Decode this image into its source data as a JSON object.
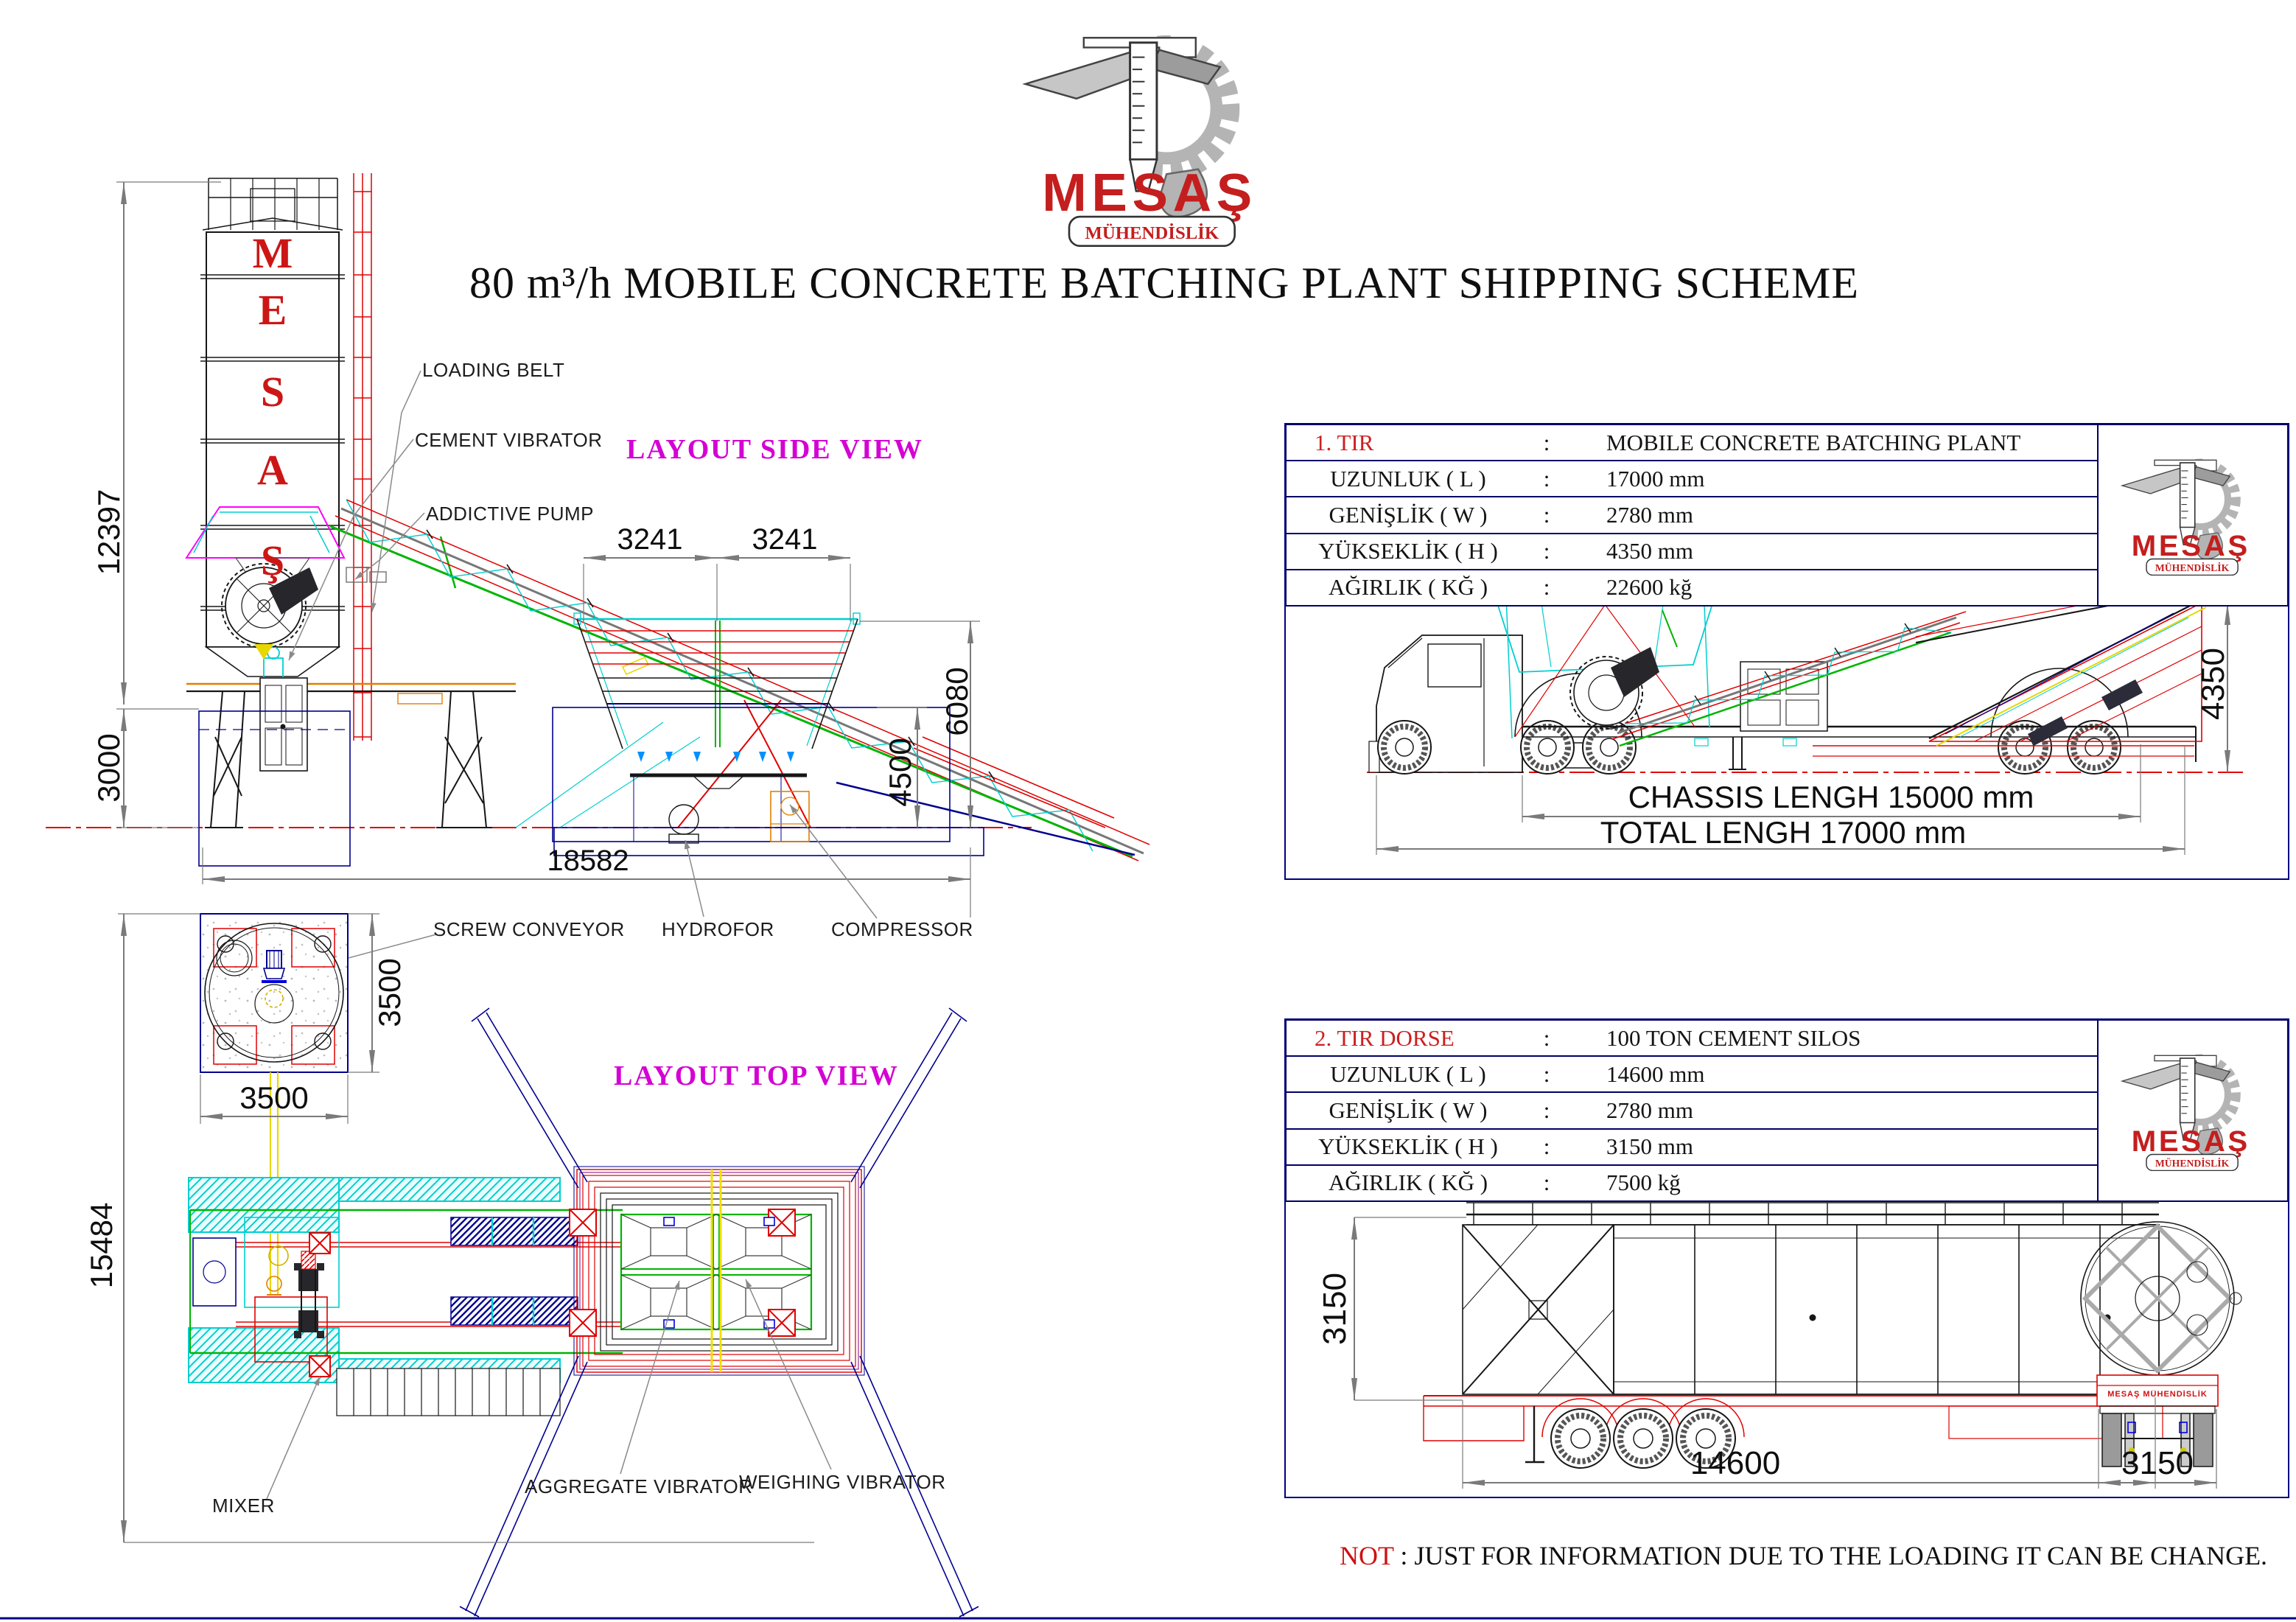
{
  "logo": {
    "brand": "MESAŞ",
    "tagline": "MÜHENDİSLİK"
  },
  "title": "80 m³/h MOBILE CONCRETE BATCHING PLANT SHIPPING SCHEME",
  "side_view": {
    "heading": "LAYOUT SIDE VIEW",
    "silo_letters": [
      "M",
      "E",
      "S",
      "A",
      "Ş"
    ],
    "labels": {
      "loading_belt": "LOADING BELT",
      "cement_vibrator": "CEMENT VIBRATOR",
      "addictive_pump": "ADDICTIVE PUMP",
      "screw_conveyor": "SCREW CONVEYOR",
      "hydrofor": "HYDROFOR",
      "compressor": "COMPRESSOR"
    },
    "dims": {
      "silo_height": "12397",
      "base_height": "3000",
      "bin_span_left": "3241",
      "bin_span_right": "3241",
      "bin_height": "4500",
      "bin_top_height": "6080",
      "total_length": "18582"
    }
  },
  "top_view": {
    "heading": "LAYOUT TOP VIEW",
    "labels": {
      "mixer": "MIXER",
      "aggregate_vibrator": "AGGREGATE VIBRATOR",
      "weighing_vibrator": "WEIGHING VIBRATOR"
    },
    "dims": {
      "silo_width": "3500",
      "silo_depth": "3500",
      "total_length": "15484"
    }
  },
  "truck_view": {
    "chassis_label": "CHASSIS LENGH 15000 mm",
    "total_label": "TOTAL LENGH 17000 mm",
    "dims": {
      "height": "4350"
    }
  },
  "trailer_view": {
    "mudflap_text": "MESAŞ MÜHENDİSLİK",
    "dims": {
      "height": "3150",
      "length": "14600",
      "width": "3150"
    }
  },
  "spec_table_1": {
    "rows": [
      {
        "label": "1. TIR",
        "sep": ":",
        "value": "MOBILE CONCRETE BATCHING PLANT"
      },
      {
        "label": "UZUNLUK ( L )",
        "sep": ":",
        "value": "17000 mm"
      },
      {
        "label": "GENİŞLİK ( W )",
        "sep": ":",
        "value": "2780 mm"
      },
      {
        "label": "YÜKSEKLİK ( H )",
        "sep": ":",
        "value": "4350 mm"
      },
      {
        "label": "AĞIRLIK ( KĞ )",
        "sep": ":",
        "value": "22600 kğ"
      }
    ]
  },
  "spec_table_2": {
    "rows": [
      {
        "label": "2. TIR DORSE",
        "sep": ":",
        "value": "100 TON CEMENT SILOS"
      },
      {
        "label": "UZUNLUK ( L )",
        "sep": ":",
        "value": "14600 mm"
      },
      {
        "label": "GENİŞLİK ( W )",
        "sep": ":",
        "value": "2780 mm"
      },
      {
        "label": "YÜKSEKLİK ( H )",
        "sep": ":",
        "value": "3150 mm"
      },
      {
        "label": "AĞIRLIK ( KĞ )",
        "sep": ":",
        "value": "7500 kğ"
      }
    ]
  },
  "note": {
    "prefix": "NOT",
    "body": " : JUST FOR INFORMATION DUE TO THE LOADING IT CAN BE CHANGE."
  },
  "colors": {
    "cad_red": "#e00000",
    "cad_green": "#00b400",
    "cad_cyan": "#00cfcf",
    "cad_navy": "#000080",
    "cad_magenta": "#ff00ff",
    "heading_magenta": "#d400d4",
    "brand_red": "#c41e1e",
    "dim_gray": "#7a7a7a"
  }
}
